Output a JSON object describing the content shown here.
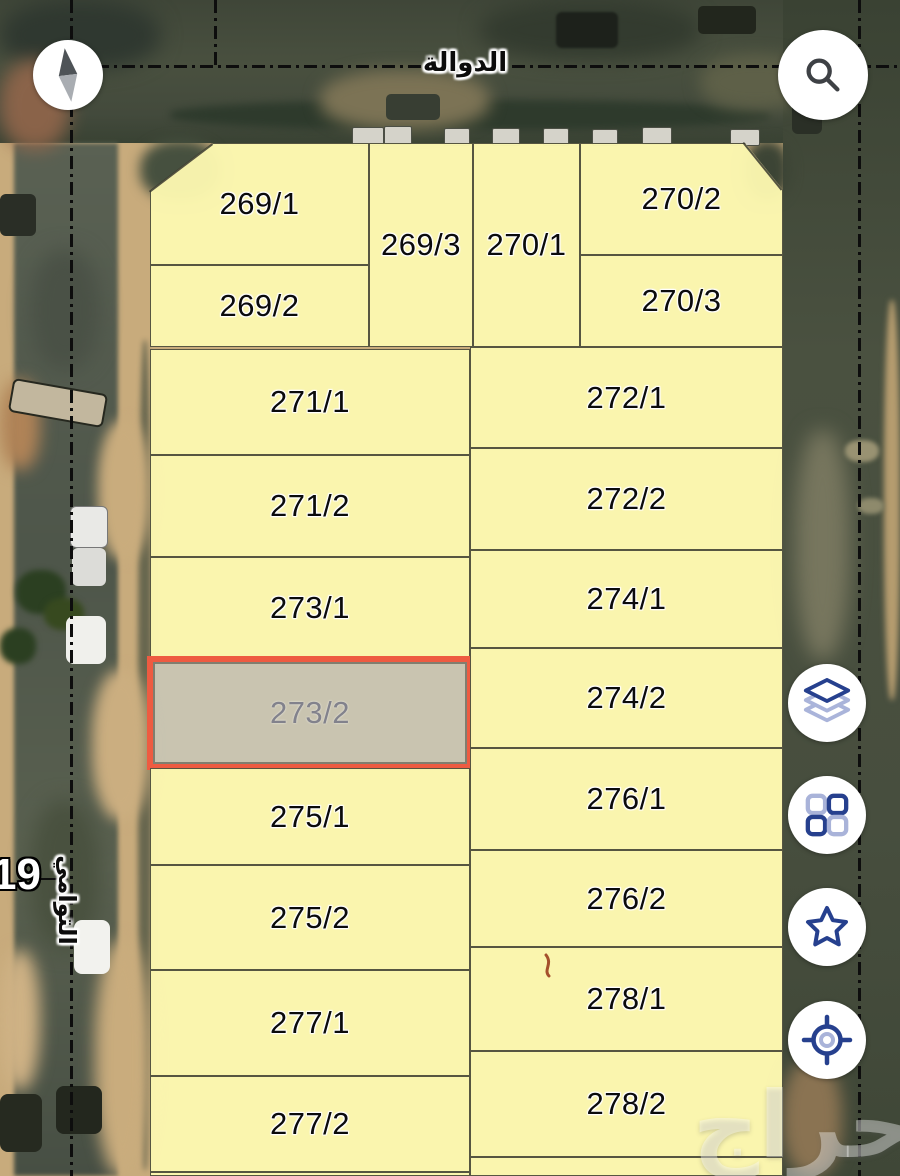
{
  "map": {
    "streets": {
      "top": "الدوالة",
      "left_vertical": "التوامي",
      "left_number": "19"
    },
    "parcels": [
      {
        "label": "269/1"
      },
      {
        "label": "269/2"
      },
      {
        "label": "269/3"
      },
      {
        "label": "270/1"
      },
      {
        "label": "270/2"
      },
      {
        "label": "270/3"
      },
      {
        "label": "271/1"
      },
      {
        "label": "271/2"
      },
      {
        "label": "272/1"
      },
      {
        "label": "272/2"
      },
      {
        "label": "273/1"
      },
      {
        "label": "273/2",
        "selected": true
      },
      {
        "label": "274/1"
      },
      {
        "label": "274/2"
      },
      {
        "label": "275/1"
      },
      {
        "label": "275/2"
      },
      {
        "label": "276/1"
      },
      {
        "label": "276/2"
      },
      {
        "label": "277/1"
      },
      {
        "label": "277/2"
      },
      {
        "label": "278/1"
      },
      {
        "label": "278/2"
      }
    ],
    "selected_parcel": "273/2",
    "colors": {
      "parcel_fill": "#FBF7AF",
      "parcel_border": "#38382E",
      "selected_fill": "#C8C4B2",
      "selected_border": "#EE5B41",
      "selected_text": "#82828C",
      "accent_blue_dark": "#26408E",
      "accent_blue_light": "#A9B3D9"
    }
  },
  "controls": {
    "compass": {
      "icon": "compass-icon"
    },
    "search": {
      "icon": "search-icon"
    },
    "layers": {
      "icon": "layers-icon"
    },
    "grid": {
      "icon": "grid-icon"
    },
    "favorites": {
      "icon": "star-icon"
    },
    "locate": {
      "icon": "locate-icon"
    }
  },
  "watermark": {
    "text": "حراج"
  }
}
